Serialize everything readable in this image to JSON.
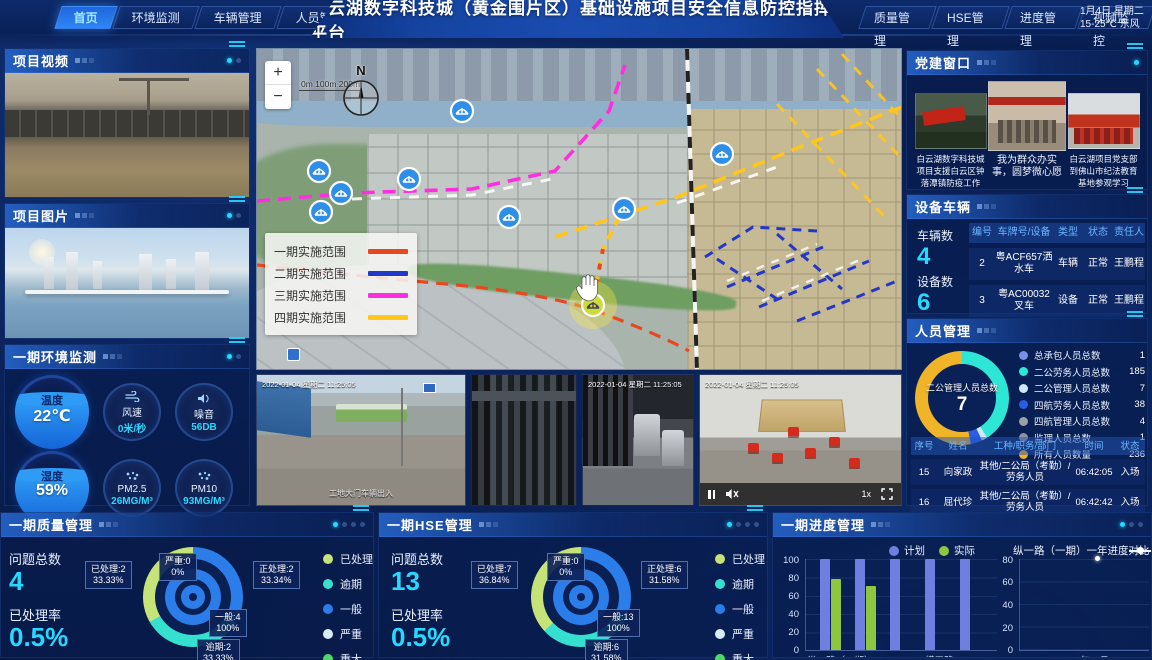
{
  "header": {
    "title": "白云湖数字科技城（黄金围片区）基础设施项目安全信息防控指挥平台",
    "left_tabs": [
      {
        "label": "首页",
        "active": true
      },
      {
        "label": "环境监测",
        "active": false
      },
      {
        "label": "车辆管理",
        "active": false
      },
      {
        "label": "人员管理",
        "active": false
      }
    ],
    "right_tabs": [
      {
        "label": "质量管理"
      },
      {
        "label": "HSE管理"
      },
      {
        "label": "进度管理"
      },
      {
        "label": "视频监控"
      }
    ],
    "date_line1": "1月4日 星期二",
    "date_line2": "15-25℃ 东风"
  },
  "project_video": {
    "title": "项目视频"
  },
  "project_photo": {
    "title": "项目图片"
  },
  "environment": {
    "title": "一期环境监测",
    "gauges": [
      {
        "label": "温度",
        "value": "22℃"
      },
      {
        "label": "风速",
        "value": "0米/秒"
      },
      {
        "label": "噪音",
        "value": "56DB"
      },
      {
        "label": "湿度",
        "value": "59%"
      },
      {
        "label": "PM2.5",
        "value": "26MG/M³"
      },
      {
        "label": "PM10",
        "value": "93MG/M³"
      }
    ]
  },
  "map": {
    "zoom_in": "+",
    "zoom_out": "−",
    "scale": "0m 100m 200m",
    "compass": "N",
    "legend": [
      {
        "label": "一期实施范围",
        "color": "#e8481f"
      },
      {
        "label": "二期实施范围",
        "color": "#2438c8"
      },
      {
        "label": "三期实施范围",
        "color": "#ff2ee0"
      },
      {
        "label": "四期实施范围",
        "color": "#ffc61c"
      }
    ]
  },
  "cameras": {
    "timestamp": "2022-01-04 星期二 11:25:05",
    "feed1_caption": "工地大门车辆出入",
    "speed": "1x"
  },
  "party": {
    "title": "党建窗口",
    "items": [
      {
        "caption": "白云湖数字科技城项目支援白云区钟落潭镇防疫工作"
      },
      {
        "caption": "我为群众办实事，圆梦微心愿"
      },
      {
        "caption": "白云湖项目党支部到佛山市纪法教育基地参观学习"
      }
    ]
  },
  "vehicles": {
    "title": "设备车辆",
    "vehicle_count_label": "车辆数",
    "vehicle_count": "4",
    "device_count_label": "设备数",
    "device_count": "6",
    "headers": [
      "编号",
      "车牌号/设备",
      "类型",
      "状态",
      "责任人"
    ],
    "rows": [
      {
        "no": "2",
        "plate": "粤ACF657洒水车",
        "type": "车辆",
        "status": "正常",
        "owner": "王鹏程"
      },
      {
        "no": "3",
        "plate": "粤AC00032叉车",
        "type": "设备",
        "status": "正常",
        "owner": "王鹏程"
      }
    ]
  },
  "personnel": {
    "title": "人员管理",
    "donut_center_label": "二公管理人员总数",
    "donut_center_value": "7",
    "legend": [
      {
        "label": "总承包人员总数",
        "value": "1",
        "color": "#7b8fe8"
      },
      {
        "label": "二公劳务人员总数",
        "value": "185",
        "color": "#2ee6d6"
      },
      {
        "label": "二公管理人员总数",
        "value": "7",
        "color": "#cfe8ff"
      },
      {
        "label": "四航劳务人员总数",
        "value": "38",
        "color": "#2b5ce6"
      },
      {
        "label": "四航管理人员总数",
        "value": "4",
        "color": "#9aa0a6"
      },
      {
        "label": "监理人员总数",
        "value": "1",
        "color": "#8a93a3"
      },
      {
        "label": "所有人员数量",
        "value": "236",
        "color": "#f0b429"
      }
    ],
    "headers": [
      "序号",
      "姓名",
      "工种/职务/部门",
      "时间",
      "状态"
    ],
    "rows": [
      {
        "no": "15",
        "name": "向家政",
        "job": "其他/二公局（考勤）/劳务人员",
        "time": "06:42:05",
        "status": "入场"
      },
      {
        "no": "16",
        "name": "屈代珍",
        "job": "其他/二公局（考勤）/劳务人员",
        "time": "06:42:42",
        "status": "入场"
      }
    ]
  },
  "quality": {
    "title": "一期质量管理",
    "total_label": "问题总数",
    "total": "4",
    "rate_label": "已处理率",
    "rate": "0.5%",
    "callouts": [
      {
        "line1": "已处理:2",
        "line2": "33.33%"
      },
      {
        "line1": "严重:0",
        "line2": "0%"
      },
      {
        "line1": "正处理:2",
        "line2": "33.34%"
      },
      {
        "line1": "一般:4",
        "line2": "100%"
      },
      {
        "line1": "逾期:2",
        "line2": "33.33%"
      }
    ],
    "legend": [
      {
        "label": "已处理",
        "color": "#c6e377"
      },
      {
        "label": "逾期",
        "color": "#35e0d0"
      },
      {
        "label": "一般",
        "color": "#2b7de9"
      },
      {
        "label": "严重",
        "color": "#d7ecf5"
      },
      {
        "label": "重大",
        "color": "#4cd964"
      }
    ]
  },
  "hse": {
    "title": "一期HSE管理",
    "total_label": "问题总数",
    "total": "13",
    "rate_label": "已处理率",
    "rate": "0.5%",
    "callouts": [
      {
        "line1": "已处理:7",
        "line2": "36.84%"
      },
      {
        "line1": "严重:0",
        "line2": "0%"
      },
      {
        "line1": "正处理:6",
        "line2": "31.58%"
      },
      {
        "line1": "一般:13",
        "line2": "100%"
      },
      {
        "line1": "逾期:6",
        "line2": "31.58%"
      }
    ],
    "legend": [
      {
        "label": "已处理",
        "color": "#c6e377"
      },
      {
        "label": "逾期",
        "color": "#35e0d0"
      },
      {
        "label": "一般",
        "color": "#2b7de9"
      },
      {
        "label": "严重",
        "color": "#d7ecf5"
      },
      {
        "label": "重大",
        "color": "#4cd964"
      }
    ]
  },
  "progress": {
    "title": "一期进度管理",
    "bar_yticks": [
      "100",
      "80",
      "60",
      "40",
      "20",
      "0"
    ],
    "bar_xlabel1": "纵一路（一期）",
    "bar_xlabel2": "横三路",
    "line_title": "纵一路（一期）一年进度对比",
    "line_legend": "实际",
    "line_yticks": [
      "80",
      "60",
      "40",
      "20",
      "0"
    ],
    "line_xlabel": "2021年11月"
  },
  "chart_data": [
    {
      "id": "quality-donut",
      "type": "pie",
      "title": "一期质量管理",
      "segments": [
        {
          "label": "正处理",
          "value": 2,
          "pct": 33.34,
          "color": "#2b7de9"
        },
        {
          "label": "逾期",
          "value": 2,
          "pct": 33.33,
          "color": "#35e0d0"
        },
        {
          "label": "已处理",
          "value": 2,
          "pct": 33.33,
          "color": "#c6e377"
        }
      ],
      "inner_ring": {
        "label": "一般",
        "value": 4,
        "pct": 100,
        "color": "#2b7de9"
      },
      "zero_segment": {
        "label": "严重",
        "value": 0,
        "pct": 0
      }
    },
    {
      "id": "hse-donut",
      "type": "pie",
      "title": "一期HSE管理",
      "segments": [
        {
          "label": "正处理",
          "value": 6,
          "pct": 31.58,
          "color": "#2b7de9"
        },
        {
          "label": "逾期",
          "value": 6,
          "pct": 31.58,
          "color": "#35e0d0"
        },
        {
          "label": "已处理",
          "value": 7,
          "pct": 36.84,
          "color": "#c6e377"
        }
      ],
      "inner_ring": {
        "label": "一般",
        "value": 13,
        "pct": 100,
        "color": "#2b7de9"
      },
      "zero_segment": {
        "label": "严重",
        "value": 0,
        "pct": 0
      }
    },
    {
      "id": "personnel-donut",
      "type": "pie",
      "title": "人员管理",
      "segments": [
        {
          "label": "二公劳务人员总数",
          "value": 185,
          "pct": 41,
          "color": "#2ee6d6"
        },
        {
          "label": "二公管理人员总数",
          "value": 7,
          "pct": 2,
          "color": "#cfe8ff"
        },
        {
          "label": "四航劳务人员总数",
          "value": 38,
          "pct": 4,
          "color": "#2b5ce6"
        },
        {
          "label": "所有人员数量",
          "value": 236,
          "pct": 53,
          "color": "#f0b429"
        }
      ]
    },
    {
      "id": "progress-bars",
      "type": "bar",
      "title": "一期进度管理",
      "categories": [
        "纵一路（一期）",
        "",
        "",
        "横三路",
        ""
      ],
      "series": [
        {
          "name": "计划",
          "color": "#6e7fe0",
          "values": [
            100,
            100,
            100,
            100,
            100
          ]
        },
        {
          "name": "实际",
          "color": "#8ec63f",
          "values": [
            78,
            70,
            null,
            null,
            null
          ]
        }
      ],
      "ylim": [
        0,
        100
      ]
    },
    {
      "id": "progress-line",
      "type": "line",
      "title": "纵一路（一期）一年进度对比",
      "series": [
        {
          "name": "实际",
          "color": "#ffffff",
          "points": [
            {
              "x": "2021年11月",
              "y": 78,
              "xfrac": 0.58
            }
          ]
        }
      ],
      "ylim": [
        0,
        80
      ]
    }
  ]
}
